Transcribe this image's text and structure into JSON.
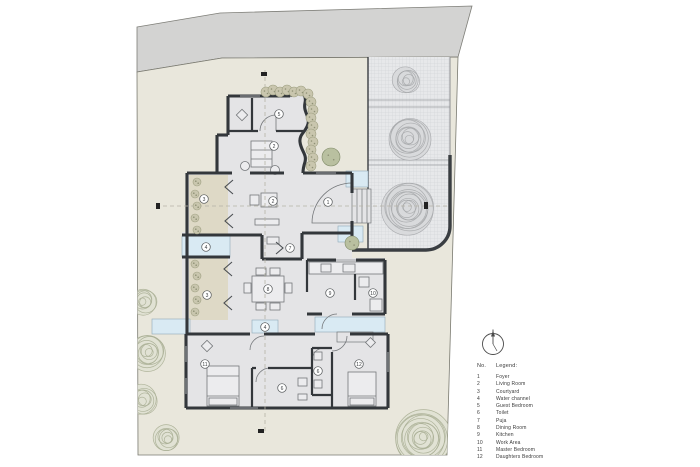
{
  "scene": {
    "background": "#ffffff",
    "road": {
      "fill": "#d3d3d2",
      "stroke": "#7e7e78"
    },
    "site": {
      "fill": "#e9e7dc",
      "stroke": "#7a7a70"
    },
    "paving": {
      "fill": "#e7e8ea",
      "grid": "#cdced2",
      "border": "#3a3e42",
      "divider": "#9a9ca0"
    },
    "house": {
      "floor": "#e4e4e6",
      "wall": "#33373b",
      "thin": "#74777a",
      "window": "#9fa2a5"
    },
    "water": "#d9eaf3",
    "water_edge": "#8fa9b8",
    "courtyard_fill": "#ded9c6",
    "tree_green": "#a9ae93",
    "tree_green_fill": "#e0e2d3",
    "tree_gray": "#a6a8ab",
    "tree_gray_fill": "#d8d9db",
    "shrub": "#c9c6ae",
    "shrub_stroke": "#9fa083",
    "shrub_dot": "#8f9176",
    "label_stroke": "#55585a",
    "label_text": "#3a3d40",
    "centerline": "#b5b3a6",
    "marker": "#222222"
  },
  "room_labels": [
    {
      "no": "1",
      "x": 328,
      "y": 202
    },
    {
      "no": "2",
      "x": 274,
      "y": 146
    },
    {
      "no": "2",
      "x": 273,
      "y": 201
    },
    {
      "no": "3",
      "x": 204,
      "y": 199
    },
    {
      "no": "3",
      "x": 207,
      "y": 295
    },
    {
      "no": "4",
      "x": 206,
      "y": 247
    },
    {
      "no": "4",
      "x": 265,
      "y": 327
    },
    {
      "no": "5",
      "x": 279,
      "y": 114
    },
    {
      "no": "6",
      "x": 282,
      "y": 388
    },
    {
      "no": "6",
      "x": 318,
      "y": 371
    },
    {
      "no": "7",
      "x": 290,
      "y": 248
    },
    {
      "no": "8",
      "x": 268,
      "y": 289
    },
    {
      "no": "9",
      "x": 330,
      "y": 293
    },
    {
      "no": "10",
      "x": 373,
      "y": 293
    },
    {
      "no": "11",
      "x": 205,
      "y": 364
    },
    {
      "no": "12",
      "x": 359,
      "y": 364
    }
  ],
  "site_trees": [
    {
      "x": 144,
      "y": 301,
      "r": 13
    },
    {
      "x": 148,
      "y": 352,
      "r": 18
    },
    {
      "x": 143,
      "y": 400,
      "r": 15
    },
    {
      "x": 167,
      "y": 438,
      "r": 13
    },
    {
      "x": 422,
      "y": 438,
      "r": 28
    }
  ],
  "paved_trees": [
    {
      "x": 407,
      "y": 80,
      "r": 13
    },
    {
      "x": 409,
      "y": 138,
      "r": 21
    },
    {
      "x": 408,
      "y": 208,
      "r": 26
    }
  ],
  "hedge": [
    {
      "x": 266,
      "y": 92,
      "r": 5
    },
    {
      "x": 273,
      "y": 90,
      "r": 5
    },
    {
      "x": 280,
      "y": 92,
      "r": 5
    },
    {
      "x": 287,
      "y": 90,
      "r": 5
    },
    {
      "x": 294,
      "y": 92,
      "r": 5
    },
    {
      "x": 301,
      "y": 91,
      "r": 5
    },
    {
      "x": 308,
      "y": 94,
      "r": 5
    },
    {
      "x": 311,
      "y": 102,
      "r": 5
    },
    {
      "x": 313,
      "y": 110,
      "r": 5
    },
    {
      "x": 311,
      "y": 118,
      "r": 5
    },
    {
      "x": 313,
      "y": 126,
      "r": 5
    },
    {
      "x": 311,
      "y": 134,
      "r": 5
    },
    {
      "x": 313,
      "y": 142,
      "r": 5
    },
    {
      "x": 311,
      "y": 150,
      "r": 5
    },
    {
      "x": 313,
      "y": 158,
      "r": 5
    },
    {
      "x": 311,
      "y": 166,
      "r": 5
    }
  ],
  "courtyard_shrubs": [
    {
      "x": 197,
      "y": 182,
      "r": 4
    },
    {
      "x": 195,
      "y": 194,
      "r": 4
    },
    {
      "x": 197,
      "y": 206,
      "r": 4
    },
    {
      "x": 195,
      "y": 218,
      "r": 4
    },
    {
      "x": 197,
      "y": 230,
      "r": 4
    },
    {
      "x": 195,
      "y": 264,
      "r": 4
    },
    {
      "x": 197,
      "y": 276,
      "r": 4
    },
    {
      "x": 195,
      "y": 288,
      "r": 4
    },
    {
      "x": 197,
      "y": 300,
      "r": 4
    },
    {
      "x": 195,
      "y": 312,
      "r": 4
    }
  ],
  "plants": [
    {
      "x": 352,
      "y": 243,
      "r": 7
    },
    {
      "x": 331,
      "y": 157,
      "r": 9
    }
  ],
  "north_arrow": {
    "x": 493,
    "y": 344,
    "r": 10.5
  },
  "legend": {
    "no_header": "No.",
    "title": "Legend:",
    "items": [
      {
        "no": "1",
        "name": "Foyer"
      },
      {
        "no": "2",
        "name": "Living Room"
      },
      {
        "no": "3",
        "name": "Courtyard"
      },
      {
        "no": "4",
        "name": "Water channel"
      },
      {
        "no": "5",
        "name": "Guest Bedroom"
      },
      {
        "no": "6",
        "name": "Toilet"
      },
      {
        "no": "7",
        "name": "Puja"
      },
      {
        "no": "8",
        "name": "Dining Room"
      },
      {
        "no": "9",
        "name": "Kitchen"
      },
      {
        "no": "10",
        "name": "Work Area"
      },
      {
        "no": "11",
        "name": "Master Bedroom"
      },
      {
        "no": "12",
        "name": "Daughters Bedroom"
      }
    ]
  }
}
